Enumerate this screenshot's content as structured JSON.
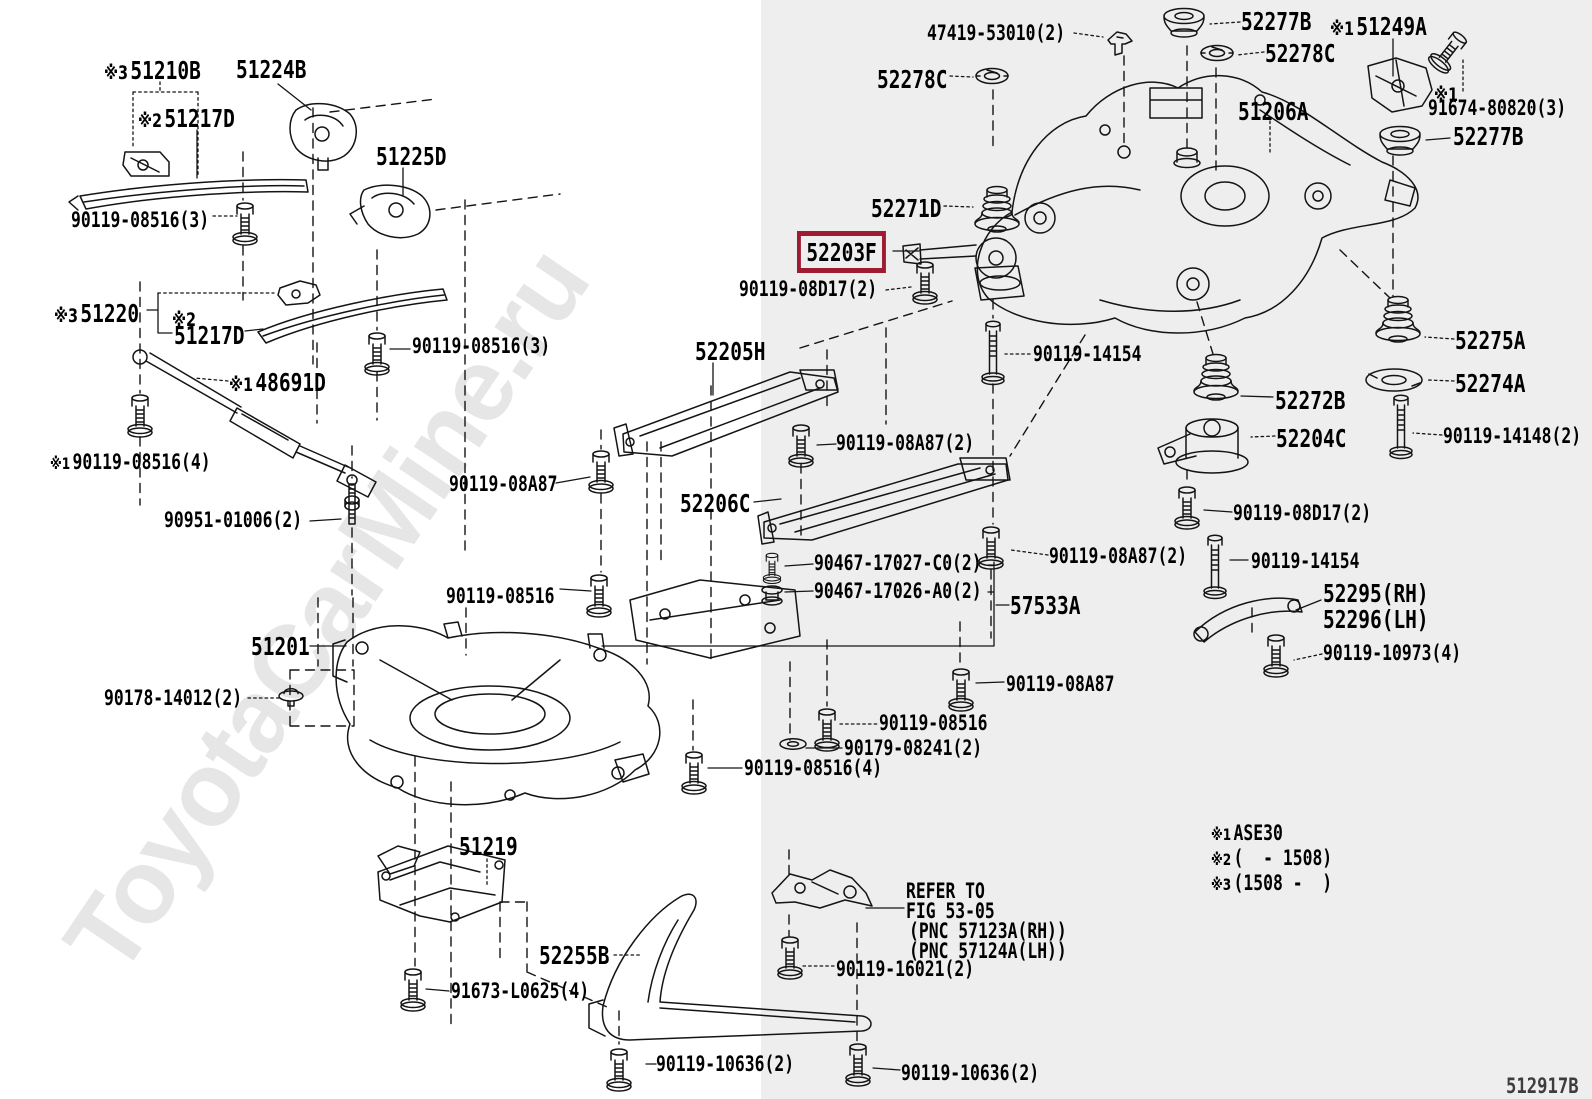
{
  "diagram": {
    "watermark": "ToyotaCarMine.ru",
    "footer_code": "512917B",
    "background_color": "#ffffff",
    "panel_color": "#eeeeee",
    "panel_left": 761,
    "line_color": "#141414",
    "highlight_color": "#9e1b32",
    "labels": [
      {
        "name": "label-51210b",
        "prefix": "※3",
        "text": "51210B",
        "x": 104,
        "y": 58,
        "size": "lg"
      },
      {
        "name": "label-51224b",
        "text": "51224B",
        "x": 236,
        "y": 57,
        "size": "lg"
      },
      {
        "name": "label-51217d-upper",
        "prefix": "※2",
        "text": "51217D",
        "x": 138,
        "y": 106,
        "size": "lg"
      },
      {
        "name": "label-51225d",
        "text": "51225D",
        "x": 376,
        "y": 144,
        "size": "lg"
      },
      {
        "name": "label-90119-08516-3-a",
        "text": "90119-08516(3)",
        "x": 71,
        "y": 210,
        "size": "sm"
      },
      {
        "name": "label-51220",
        "prefix": "※3",
        "text": "51220",
        "x": 54,
        "y": 301,
        "size": "lg"
      },
      {
        "name": "label-note2-mark",
        "prefix": "※2",
        "text": "",
        "x": 172,
        "y": 305,
        "size": "lg"
      },
      {
        "name": "label-51217d-lower",
        "text": "51217D",
        "x": 174,
        "y": 323,
        "size": "lg"
      },
      {
        "name": "label-90119-08516-3-b",
        "text": "90119-08516(3)",
        "x": 412,
        "y": 336,
        "size": "sm"
      },
      {
        "name": "label-48691d",
        "prefix": "※1",
        "text": "48691D",
        "x": 229,
        "y": 370,
        "size": "lg"
      },
      {
        "name": "label-90119-08516-4-left",
        "prefix": "※1",
        "text": "90119-08516(4)",
        "x": 50,
        "y": 452,
        "size": "sm"
      },
      {
        "name": "label-90119-08a87-left",
        "text": "90119-08A87",
        "x": 449,
        "y": 474,
        "size": "sm"
      },
      {
        "name": "label-90951-01006",
        "text": "90951-01006(2)",
        "x": 164,
        "y": 510,
        "size": "sm"
      },
      {
        "name": "label-90119-08516-left",
        "text": "90119-08516",
        "x": 446,
        "y": 586,
        "size": "sm"
      },
      {
        "name": "label-51201",
        "text": "51201",
        "x": 251,
        "y": 634,
        "size": "lg"
      },
      {
        "name": "label-90178-14012",
        "text": "90178-14012(2)",
        "x": 104,
        "y": 688,
        "size": "sm"
      },
      {
        "name": "label-51219",
        "text": "51219",
        "x": 459,
        "y": 834,
        "size": "lg"
      },
      {
        "name": "label-52255b",
        "text": "52255B",
        "x": 539,
        "y": 943,
        "size": "lg"
      },
      {
        "name": "label-91673-l0625",
        "text": "91673-L0625(4)",
        "x": 451,
        "y": 981,
        "size": "sm"
      },
      {
        "name": "label-90119-10636-left",
        "text": "90119-10636(2)",
        "x": 656,
        "y": 1054,
        "size": "sm"
      },
      {
        "name": "label-90119-10636-right",
        "text": "90119-10636(2)",
        "x": 901,
        "y": 1063,
        "size": "sm"
      },
      {
        "name": "label-52205h",
        "text": "52205H",
        "x": 695,
        "y": 339,
        "size": "lg"
      },
      {
        "name": "label-90119-08a87-2-mid",
        "text": "90119-08A87(2)",
        "x": 836,
        "y": 433,
        "size": "sm"
      },
      {
        "name": "label-52206c",
        "text": "52206C",
        "x": 680,
        "y": 491,
        "size": "lg"
      },
      {
        "name": "label-90467-17027",
        "text": "90467-17027-C0(2)",
        "x": 814,
        "y": 553,
        "size": "sm"
      },
      {
        "name": "label-90467-17026",
        "text": "90467-17026-A0(2)",
        "x": 814,
        "y": 581,
        "size": "sm"
      },
      {
        "name": "label-57533a",
        "text": "57533A",
        "x": 1010,
        "y": 593,
        "size": "lg"
      },
      {
        "name": "label-90119-08a87-bottom",
        "text": "90119-08A87",
        "x": 1006,
        "y": 674,
        "size": "sm"
      },
      {
        "name": "label-90119-08516-mid",
        "text": "90119-08516",
        "x": 879,
        "y": 713,
        "size": "sm"
      },
      {
        "name": "label-90179-08241",
        "text": "90179-08241(2)",
        "x": 844,
        "y": 738,
        "size": "sm"
      },
      {
        "name": "label-90119-08516-4-mid",
        "text": "90119-08516(4)",
        "x": 744,
        "y": 758,
        "size": "sm"
      },
      {
        "name": "refer-note-line-1",
        "text": "REFER TO",
        "x": 906,
        "y": 881,
        "size": "sm"
      },
      {
        "name": "refer-note-line-2",
        "text": "FIG 53-05",
        "x": 906,
        "y": 901,
        "size": "sm"
      },
      {
        "name": "refer-note-line-3",
        "text": "(PNC 57123A(RH))",
        "x": 909,
        "y": 921,
        "size": "sm"
      },
      {
        "name": "refer-note-line-4",
        "text": "(PNC 57124A(LH))",
        "x": 909,
        "y": 941,
        "size": "sm"
      },
      {
        "name": "label-90119-16021",
        "text": "90119-16021(2)",
        "x": 836,
        "y": 959,
        "size": "sm"
      },
      {
        "name": "label-47419-53010",
        "text": "47419-53010(2)",
        "x": 927,
        "y": 23,
        "size": "sm"
      },
      {
        "name": "label-52278c-left",
        "text": "52278C",
        "x": 877,
        "y": 67,
        "size": "lg"
      },
      {
        "name": "label-52271d",
        "text": "52271D",
        "x": 871,
        "y": 196,
        "size": "lg"
      },
      {
        "name": "label-52203f",
        "text": "52203F",
        "x": 797,
        "y": 231,
        "size": "lg",
        "highlight": true
      },
      {
        "name": "label-90119-08d17-left",
        "text": "90119-08D17(2)",
        "x": 739,
        "y": 279,
        "size": "sm"
      },
      {
        "name": "label-90119-14154-top",
        "text": "90119-14154",
        "x": 1033,
        "y": 344,
        "size": "sm"
      },
      {
        "name": "label-52277b-top",
        "text": "52277B",
        "x": 1241,
        "y": 9,
        "size": "lg"
      },
      {
        "name": "label-51249a",
        "prefix": "※1",
        "text": "51249A",
        "x": 1330,
        "y": 14,
        "size": "lg"
      },
      {
        "name": "label-52278c-right",
        "text": "52278C",
        "x": 1265,
        "y": 41,
        "size": "lg"
      },
      {
        "name": "label-51206a",
        "text": "51206A",
        "x": 1238,
        "y": 99,
        "size": "lg"
      },
      {
        "name": "label-note1-mark",
        "prefix": "※1",
        "text": "",
        "x": 1434,
        "y": 80,
        "size": "lg"
      },
      {
        "name": "label-91674-80820",
        "text": "91674-80820(3)",
        "x": 1428,
        "y": 98,
        "size": "sm"
      },
      {
        "name": "label-52277b-right",
        "text": "52277B",
        "x": 1453,
        "y": 124,
        "size": "lg"
      },
      {
        "name": "label-52275a",
        "text": "52275A",
        "x": 1455,
        "y": 328,
        "size": "lg"
      },
      {
        "name": "label-52274a",
        "text": "52274A",
        "x": 1455,
        "y": 371,
        "size": "lg"
      },
      {
        "name": "label-90119-14148",
        "text": "90119-14148(2)",
        "x": 1443,
        "y": 426,
        "size": "sm"
      },
      {
        "name": "label-52272b",
        "text": "52272B",
        "x": 1275,
        "y": 388,
        "size": "lg"
      },
      {
        "name": "label-52204c",
        "text": "52204C",
        "x": 1276,
        "y": 426,
        "size": "lg"
      },
      {
        "name": "label-90119-08d17-right",
        "text": "90119-08D17(2)",
        "x": 1233,
        "y": 503,
        "size": "sm"
      },
      {
        "name": "label-90119-08a87-2-right",
        "text": "90119-08A87(2)",
        "x": 1049,
        "y": 546,
        "size": "sm"
      },
      {
        "name": "label-90119-14154-right",
        "text": "90119-14154",
        "x": 1251,
        "y": 551,
        "size": "sm"
      },
      {
        "name": "label-52295-rh",
        "text": "52295(RH)",
        "x": 1323,
        "y": 581,
        "size": "lg"
      },
      {
        "name": "label-52296-lh",
        "text": "52296(LH)",
        "x": 1323,
        "y": 607,
        "size": "lg"
      },
      {
        "name": "label-90119-10973",
        "text": "90119-10973(4)",
        "x": 1323,
        "y": 643,
        "size": "sm"
      },
      {
        "name": "note-1",
        "prefix": "※1",
        "text": "ASE30",
        "x": 1211,
        "y": 823,
        "size": "sm"
      },
      {
        "name": "note-2",
        "prefix": "※2",
        "text": "(  - 1508)",
        "x": 1211,
        "y": 848,
        "size": "sm"
      },
      {
        "name": "note-3",
        "prefix": "※3",
        "text": "(1508 -  )",
        "x": 1211,
        "y": 873,
        "size": "sm"
      }
    ]
  }
}
